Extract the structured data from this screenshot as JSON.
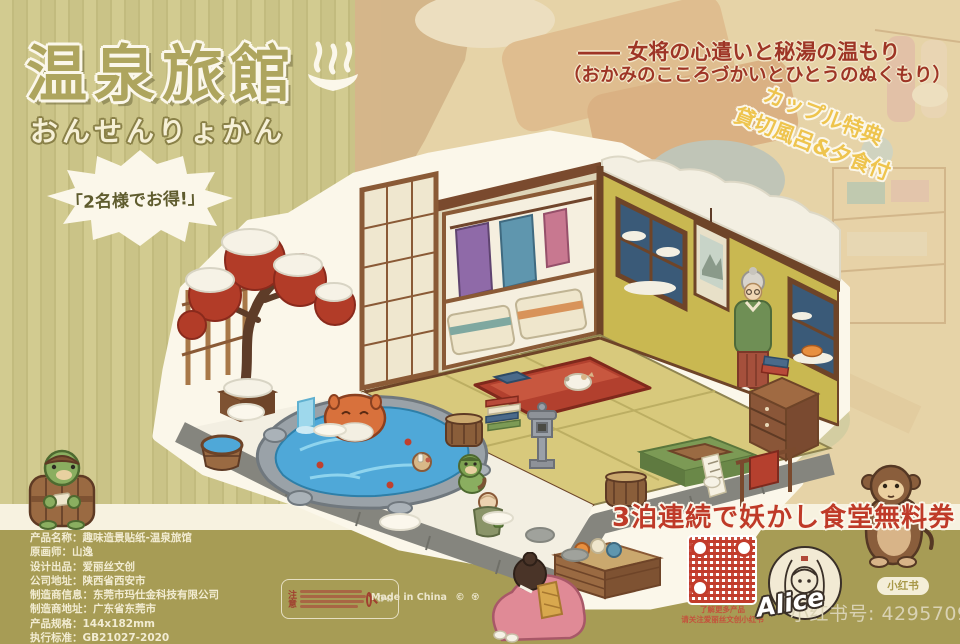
{
  "header": {
    "title": "温泉旅館",
    "title_kana": "おんせんりょかん",
    "speech_bubble": "「2名様でお得!」",
    "tagline_line1": "―― 女将の心遣いと秘湯の温もり",
    "tagline_line2": "（おかみのこころづかいとひとうのぬくもり）"
  },
  "coupon": {
    "line1": "カップル特典",
    "line2": "貸切風呂&夕食付"
  },
  "promo": {
    "text": "3泊連続で妖かし食堂無料券"
  },
  "product_info": {
    "lines": [
      "产品名称：趣味造景贴纸-温泉旅馆",
      "原画师：山逸",
      "设计出品：爱丽丝文创",
      "公司地址：陕西省西安市",
      "制造商信息：东莞市玛仕金科技有限公司",
      "制造商地址：广东省东莞市",
      "产品规格：144x182mm",
      "执行标准：GB21027-2020"
    ]
  },
  "notice": {
    "label": "注意"
  },
  "footer": {
    "made_in": "Made in China",
    "qr_caption1": "了解更多产品",
    "qr_caption2": "请关注爱丽丝文创小红书",
    "alice": "Alice",
    "xhs_badge": "小红书",
    "xhs_id": "小红书号: 42957093916"
  },
  "scene": {
    "elements": [
      "snow-covered-maple-tree",
      "open-air-bath",
      "bathing-spirit",
      "kappa",
      "wooden-bucket",
      "stone-lantern",
      "shoji-screen",
      "kimono-closet",
      "hanging-scroll",
      "snow-window",
      "innkeeper-granny",
      "sleeping-cat-on-futon",
      "kotatsu",
      "chest-of-drawers",
      "little-monk",
      "towel-rack",
      "storage-crate",
      "barrel-kappa",
      "bowing-okami",
      "monkey"
    ]
  },
  "colors": {
    "accent_red": "#9e3526",
    "gold": "#eec44e",
    "olive_strip": "#a79c55",
    "stripe_light": "#d0c98e",
    "stripe_dark": "#c5be80",
    "title_olive": "#aea55e",
    "water_blue": "#4fa8d8",
    "promo_red": "#bf3a28"
  }
}
